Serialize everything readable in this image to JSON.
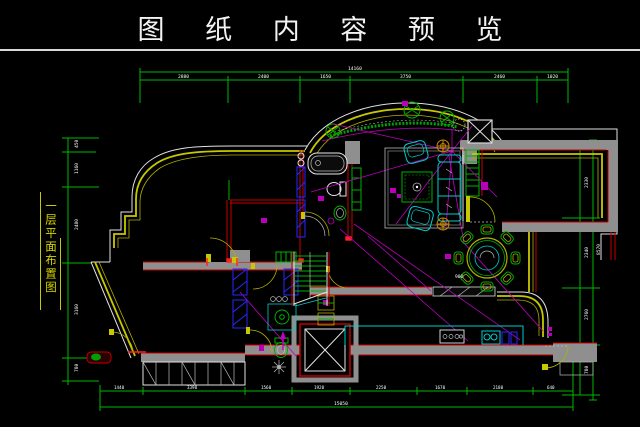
{
  "title": {
    "text": "图 纸 内 容 预 览"
  },
  "side_label": {
    "text": "一层平面布置图"
  },
  "dims": {
    "top": {
      "total": "14160",
      "segments": [
        "2880",
        "2400",
        "1650",
        "3750",
        "2460",
        "1020"
      ]
    },
    "left": {
      "segments": [
        "450",
        "1160",
        "2480",
        "3160",
        "780"
      ]
    },
    "right": {
      "total": "8570",
      "segments": [
        "360",
        "2330",
        "2340",
        "2760",
        "780"
      ]
    },
    "bottom": {
      "total": "15050",
      "segments": [
        "1440",
        "3390",
        "1560",
        "1920",
        "2250",
        "1670",
        "2180",
        "640"
      ]
    }
  },
  "plan_labels": {
    "dining_diameter": "900"
  },
  "colors": {
    "dimension_green": "#00b800",
    "wall_yellow": "#c8c800",
    "wall_red": "#cc0000",
    "wall_gray": "#8f8f8f",
    "outer_trim_white": "#e2e2e2",
    "fixture_cyan": "#00cccc",
    "furniture_green": "#00b000",
    "wiring_magenta": "#c000c0",
    "cabinet_blue": "#2828ff",
    "lamp_orange": "#cc8800"
  }
}
